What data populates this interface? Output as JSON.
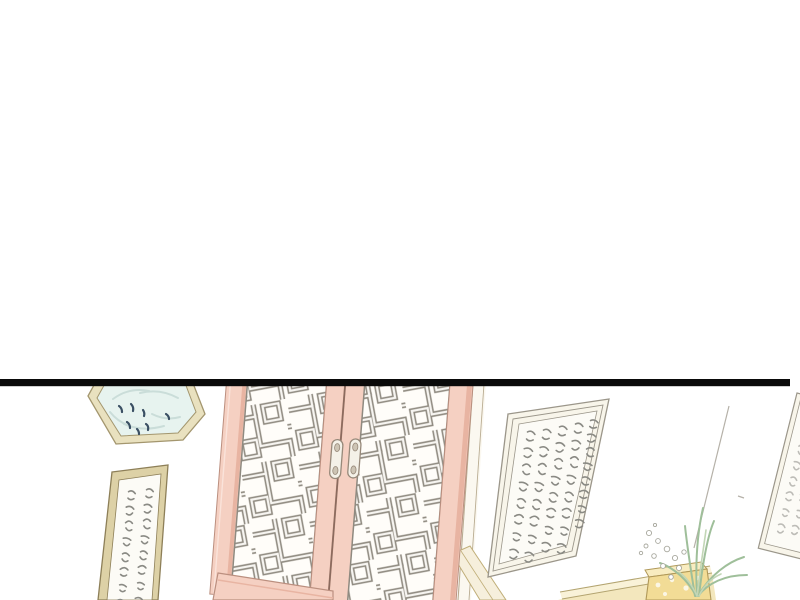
{
  "panel": {
    "kind": "webtoon-comic-panel",
    "scene_description": "Interior of a traditional Chinese room seen past a thick black panel border: a pair of pink-framed lattice sliding doors with two oval pull handles, a hexagonal plate with small blue fish above left, a hanging calligraphy scroll on the left wall, a large tilted framed calligraphy plaque on the right wall, a narrow scroll at the far right edge, and an orchid with white blossoms beside a yellow brocade box on a long pale table",
    "gutter": {
      "label": "blank white page gutter above panel"
    },
    "divider": {
      "label": "black panel top border"
    },
    "objects": [
      {
        "name": "hex-plate",
        "label": "hexagonal plate with blue fish motif",
        "fish_marks": 7
      },
      {
        "name": "left-scroll",
        "label": "hanging calligraphy scroll (illegible brushed text)",
        "text_columns": 2
      },
      {
        "name": "lattice-doors",
        "label": "double sliding doors with wooden fretwork",
        "door_count": 2,
        "handle_count": 2
      },
      {
        "name": "wall-plaque",
        "label": "tilted framed calligraphy plaque (illegible brushed text)",
        "text_columns": 5
      },
      {
        "name": "right-scroll",
        "label": "narrow hanging scroll cut by right edge",
        "text_columns": 2
      },
      {
        "name": "side-table",
        "label": "long pale wooden table"
      },
      {
        "name": "brocade-box",
        "label": "yellow box on table"
      },
      {
        "name": "orchid-plant",
        "label": "orchid leaves with small white blossoms"
      },
      {
        "name": "wall-corner",
        "label": "room corner line"
      }
    ]
  },
  "colors": {
    "wall": "#ffffff",
    "divider": "#0a0a0a",
    "ink": "#8a8a84",
    "door_pink": "#f5d0c2",
    "door_pink_shade": "#e8b4a2",
    "door_pink_light": "#fae3da",
    "stile_edge": "#bb8f7f",
    "seam": "#8a6a5e",
    "lattice": "#8f8a80",
    "lattice_hi": "#f7f5f1",
    "panel_bg": "#fffdf9",
    "handle_fill": "#f4f1e8",
    "handle_edge": "#97897a",
    "handle_dot": "#cdc4b4",
    "plate_rim": "#e9e1bf",
    "plate_edge": "#a3966e",
    "plate_water": "#e7f3ef",
    "plate_swirl": "#c9dcd8",
    "fish": "#3a4f63",
    "scroll_tan": "#ddd1a6",
    "scroll_edge": "#8d7f58",
    "paper": "#fcfbf6",
    "plaque_frame": "#f8f5ea",
    "plaque_edge": "#9b968a",
    "wall_line": "#b5b1a8",
    "jamb": "#fbf8f0",
    "jamb_line": "#b9ac92",
    "wedge": "#f6efdc",
    "wedge_line": "#c0ae78",
    "table_top": "#f3e7bd",
    "table_rim": "#f9f2d8",
    "table_line": "#b3a470",
    "box": "#f2dc96",
    "box_top": "#f8ecc0",
    "box_line": "#b09858",
    "leaf": "#9fbf9a",
    "leaf_light": "#c2d6b6",
    "flower_edge": "#a8a89e",
    "flower": "#ffffff"
  }
}
